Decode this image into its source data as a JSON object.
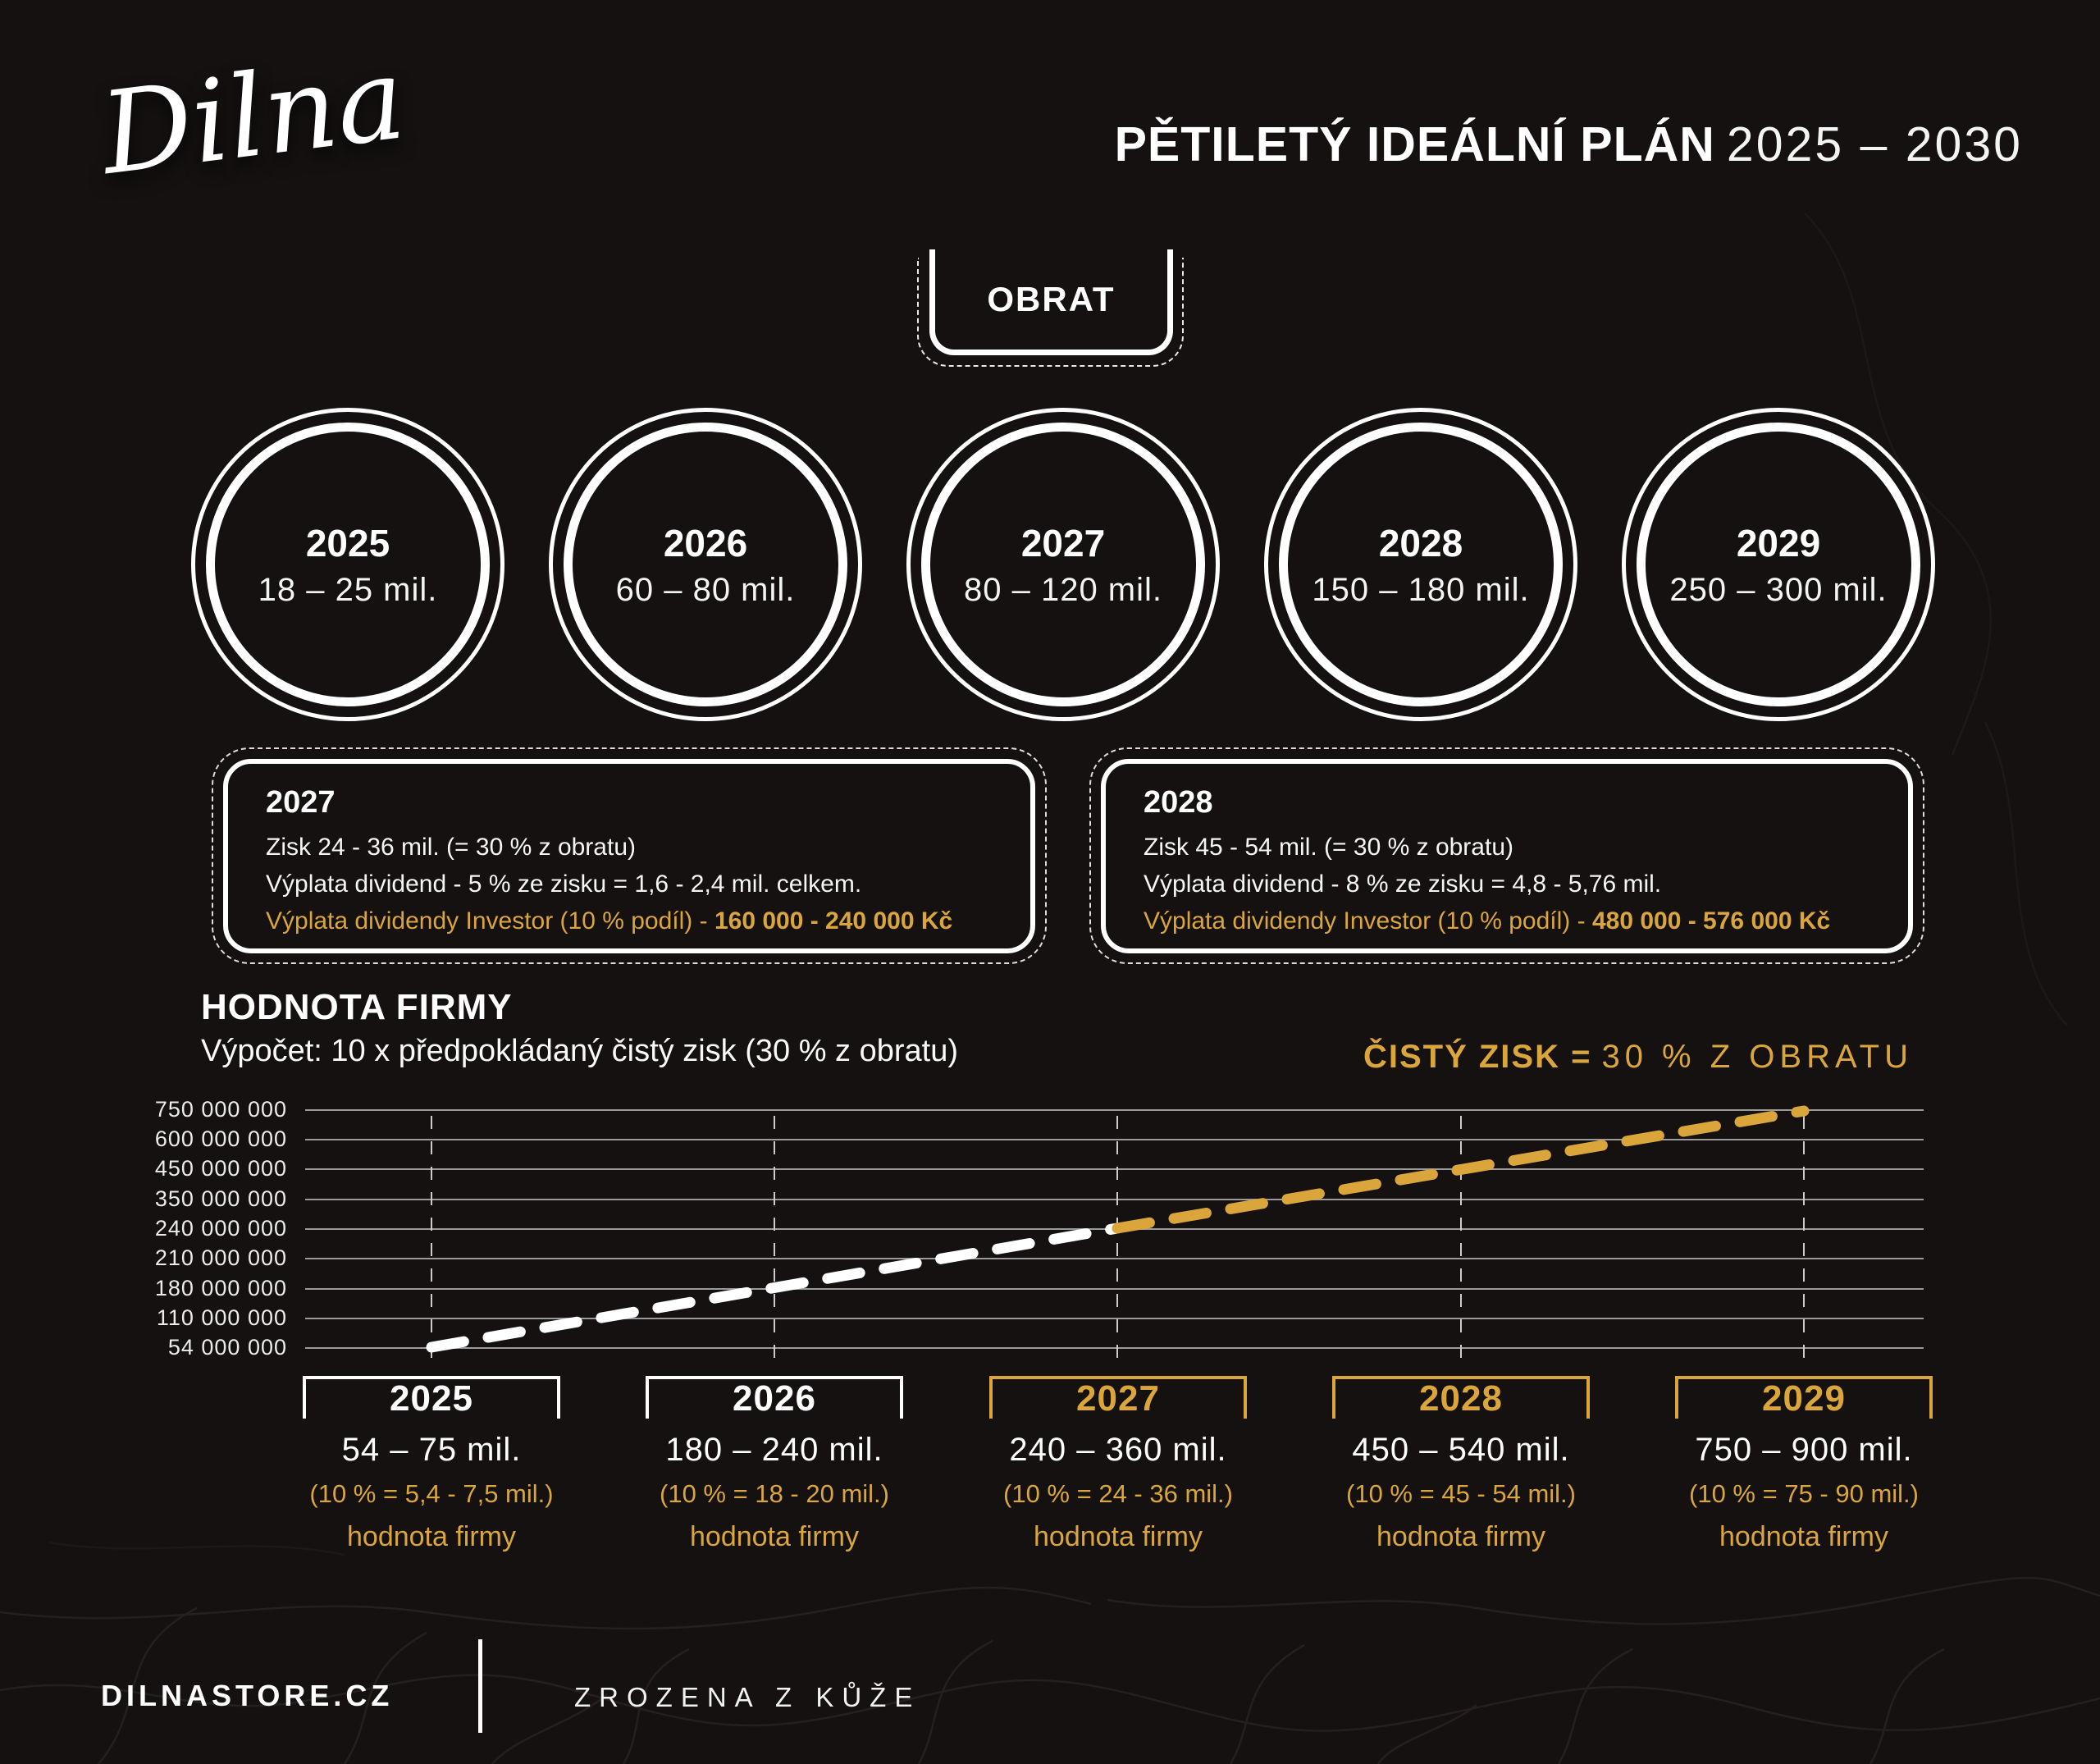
{
  "colors": {
    "background": "#141110",
    "gold": "#DAA63C",
    "white": "#FFFFFF",
    "gridline": "#9B9B9B"
  },
  "logo": {
    "text": "Dilna"
  },
  "header": {
    "title": "PĚTILETÝ IDEÁLNÍ PLÁN",
    "years": "2025 – 2030"
  },
  "obrat_badge": {
    "label": "OBRAT"
  },
  "turnover_circles": [
    {
      "year": "2025",
      "range": "18 – 25 mil."
    },
    {
      "year": "2026",
      "range": "60 – 80 mil."
    },
    {
      "year": "2027",
      "range": "80 – 120 mil."
    },
    {
      "year": "2028",
      "range": "150 – 180 mil."
    },
    {
      "year": "2029",
      "range": "250 – 300 mil."
    }
  ],
  "profit_boxes": [
    {
      "year": "2027",
      "profit_line": "Zisk 24 - 36 mil. (= 30 % z obratu)",
      "dividend_line": "Výplata dividend - 5 % ze zisku = 1,6 - 2,4 mil. celkem.",
      "investor_line": "Výplata dividendy Investor (10 % podíl) - ",
      "investor_amount": "160 000 - 240 000 Kč"
    },
    {
      "year": "2028",
      "profit_line": "Zisk 45 - 54 mil. (= 30 % z obratu)",
      "dividend_line": "Výplata dividend - 8 % ze zisku = 4,8 - 5,76 mil.",
      "investor_line": "Výplata dividendy Investor (10 % podíl) - ",
      "investor_amount": "480 000 - 576 000 Kč"
    }
  ],
  "value_section": {
    "heading": "HODNOTA FIRMY",
    "subtitle": "Výpočet: 10 x předpokládaný čistý zisk (30 % z obratu)",
    "note_bold": "ČISTÝ ZISK =",
    "note_regular": "30 % Z OBRATU"
  },
  "chart_data": {
    "type": "line",
    "title": "HODNOTA FIRMY",
    "x": [
      2025,
      2026,
      2027,
      2028,
      2029
    ],
    "series": [
      {
        "name": "hodnota firmy",
        "values": [
          54000000,
          180000000,
          240000000,
          450000000,
          750000000
        ]
      }
    ],
    "ytick_labels": [
      "750 000 000",
      "600 000 000",
      "450 000 000",
      "350 000 000",
      "240 000 000",
      "210 000 000",
      "180 000 000",
      "110 000 000",
      "54 000 000"
    ],
    "grid": true,
    "line_style": "dashed",
    "segment_colors": {
      "first": "#FFFFFF",
      "second": "#DAA63C"
    },
    "legend": "none"
  },
  "x_labels": [
    {
      "year": "2025",
      "range": "54 – 75 mil.",
      "share": "(10 % = 5,4 - 7,5 mil.)",
      "caption": "hodnota firmy"
    },
    {
      "year": "2026",
      "range": "180 – 240 mil.",
      "share": "(10 % = 18 - 20 mil.)",
      "caption": "hodnota firmy"
    },
    {
      "year": "2027",
      "range": "240 – 360 mil.",
      "share": "(10 % = 24 - 36 mil.)",
      "caption": "hodnota firmy"
    },
    {
      "year": "2028",
      "range": "450 – 540 mil.",
      "share": "(10 % = 45 - 54 mil.)",
      "caption": "hodnota firmy"
    },
    {
      "year": "2029",
      "range": "750 – 900 mil.",
      "share": "(10 % = 75 - 90 mil.)",
      "caption": "hodnota firmy"
    }
  ],
  "footer": {
    "site": "DILNASTORE.CZ",
    "slogan": "ZROZENA Z KŮŽE"
  }
}
